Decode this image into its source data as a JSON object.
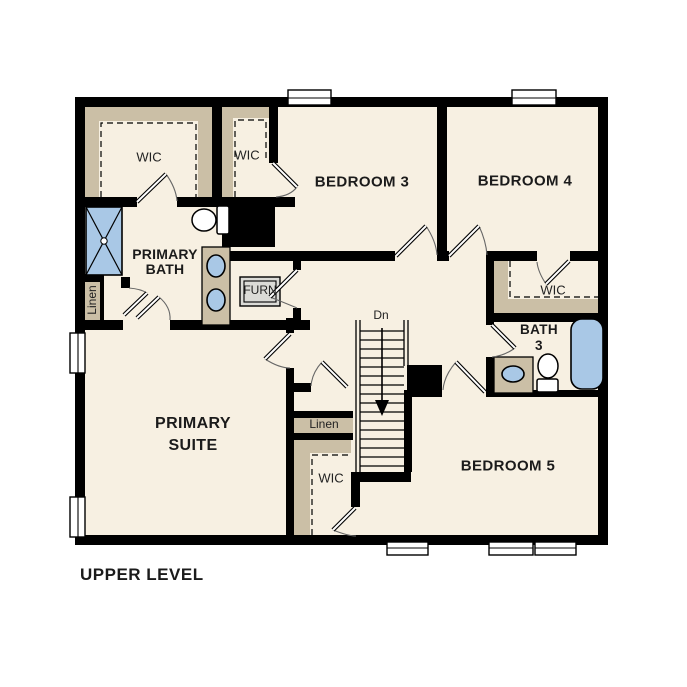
{
  "title": "UPPER LEVEL",
  "colors": {
    "background": "#ffffff",
    "floor": "#f7f0e2",
    "wall": "#000000",
    "shelf": "#cbbfa6",
    "fixture": "#a9c8e6",
    "furnace": "#dbdbd7",
    "text": "#1b1b1b",
    "arc": "#666666"
  },
  "rooms": {
    "primary_suite": {
      "label": "PRIMARY\nSUITE"
    },
    "primary_bath": {
      "label": "PRIMARY\nBATH"
    },
    "bedroom3": {
      "label": "BEDROOM 3"
    },
    "bedroom4": {
      "label": "BEDROOM 4"
    },
    "bedroom5": {
      "label": "BEDROOM 5"
    },
    "bath3": {
      "label": "BATH\n3"
    }
  },
  "closets": {
    "primary_wic": {
      "label": "WIC"
    },
    "bedroom3_wic": {
      "label": "WIC"
    },
    "bedroom4_wic": {
      "label": "WIC"
    },
    "bedroom5_wic": {
      "label": "WIC"
    },
    "primary_linen": {
      "label": "Linen"
    },
    "hall_linen": {
      "label": "Linen"
    }
  },
  "utility": {
    "furnace": {
      "label": "FURN"
    }
  },
  "stairs": {
    "label": "Dn"
  }
}
